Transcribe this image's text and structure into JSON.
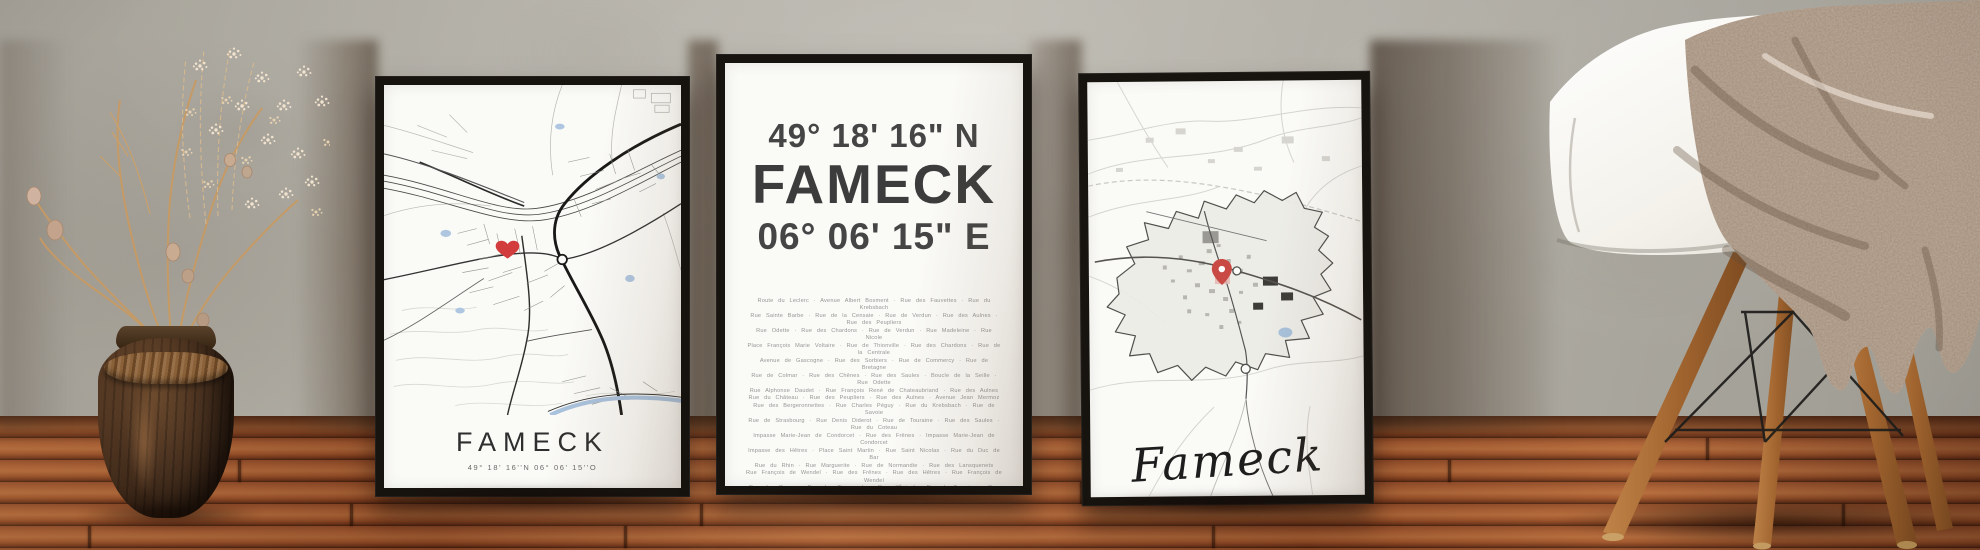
{
  "posters": {
    "left": {
      "title": "FAMECK",
      "subtitle": "49° 18' 16''N  06° 06' 15''O",
      "marker_icon": "heart-icon",
      "marker_color": "#d23c3c"
    },
    "middle": {
      "latitude": "49° 18' 16\" N",
      "title": "FAMECK",
      "longitude": "06° 06' 15\" E",
      "streets": [
        "Route du Leclerc · Avenue Albert Bosment · Rue des Fauvettes · Rue du Krebsbach",
        "Rue Sainte Barbe · Rue de la Censaie · Rue de Verdun · Rue des Aulnes · Rue des Peupliers",
        "Rue Odette · Rue des Chardons · Rue de Verdun · Rue Madeleine · Rue Nicole",
        "Place François Marie Voltaire · Rue de Thionville · Rue des Chardons · Rue de la Centrale",
        "Avenue de Gascogne · Rue des Sorbiers · Rue de Commercy · Rue de Bretagne",
        "Rue de Colmar · Rue des Chênes · Rue des Saules · Boucle de la Seille · Rue Odette",
        "Rue Alphonse Daudet · Rue François René de Chateaubriand · Rue des Aulnes",
        "Rue du Château · Rue des Peupliers · Rue des Aulnes · Avenue Jean Mermoz",
        "Rue des Bergeronnettes · Rue Charles Péguy · Rue du Krebsbach · Rue de Savoie",
        "Rue de Strasbourg · Rue Denis Diderot · Rue de Touraine · Rue des Saules · Rue du Coteau",
        "Impasse Marie-Jean de Condorcet · Rue des Frênes · Impasse Marie-Jean de Condorcet",
        "Impasse des Hêtres · Place Saint Martin · Rue Saint Nicolas · Rue du Duc de Bar",
        "Rue du Rhin · Rue Marguerite · Rue de Normandie · Rue des Lansquenets",
        "Rue François de Wendel · Rue des Frênes · Rue des Hêtres · Rue François de Wendel",
        "Rue des Roses · Rue des Tisserands · Rue d'Épinal · Rue de Touraine · Rue de la Moselle",
        "Place François Marie Voltaire · Rue Marie Thérèse · La Grande Ruelle",
        "Rue du Champ aux Trous · Rue de Saverne · Rue Saint Roch · Rue d'Alsace",
        "Rue du Château d'Eau · Avenue Jean-Jacques Rousseau · Rue de la Moselle",
        "Impasse Sainte Cécile · Rue de Saint Exupéry · Avenue Jean Mermoz · Rue Jacqueline",
        "Impasse Stendhal · Rue de la Marne · Rue de la Petite Fin"
      ]
    },
    "right": {
      "title": "Fameck",
      "subtitle": "49° 18' 16'' N  06° 06' 15'' O",
      "marker_icon": "map-pin-icon",
      "marker_color": "#c94a44"
    }
  },
  "colors": {
    "wall": "#b0ada3",
    "floor": "#8e4a28",
    "frame": "#17130f",
    "paper": "#fafaf7",
    "heart": "#d23c3c",
    "pin": "#c94a44",
    "text_dark": "#3c3c3c",
    "street_text": "#969696"
  }
}
